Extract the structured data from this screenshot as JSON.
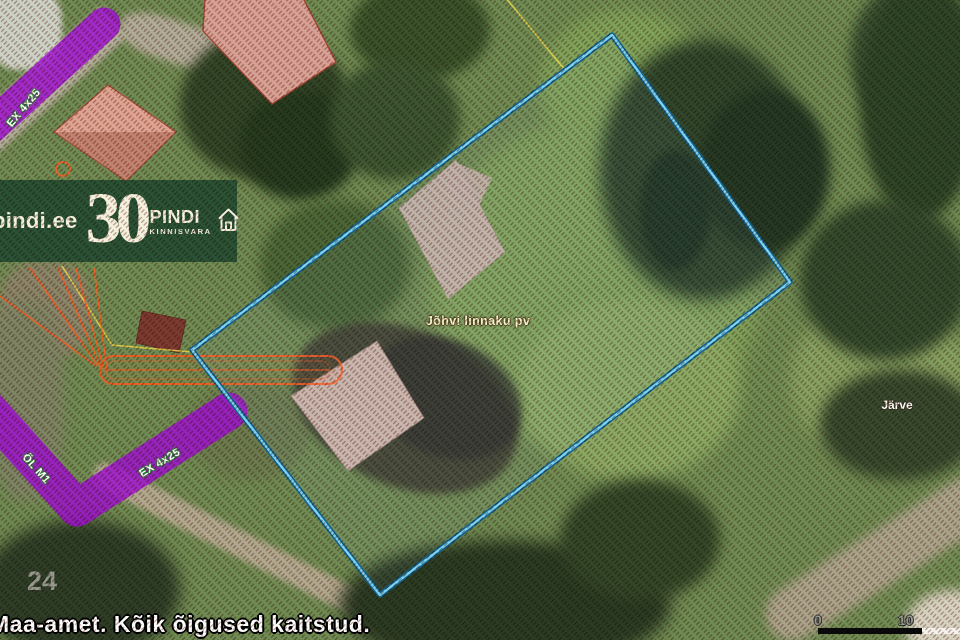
{
  "watermark_banner": {
    "site": "pindi.ee",
    "anniversary": "30",
    "brand": "PINDI",
    "brand_subtitle": "KINNISVARA",
    "background_color": "#2b5134",
    "text_color": "#f5f1e0"
  },
  "map_labels": {
    "property_name": "Jõhvi linnaku pv",
    "place_name": "Järve",
    "grid_number": "24"
  },
  "utility_labels": {
    "top_left_line": "EX 4x25",
    "left_line_vertical": "ÕL M1",
    "left_line_diagonal": "EX 4x25"
  },
  "scale_bar": {
    "start_label": "0",
    "end_label": "10"
  },
  "footer": {
    "copyright": "Maa-amet. Kõik õigused kaitstud."
  },
  "colors": {
    "parcel_boundary_outer": "#12608f",
    "parcel_boundary_inner": "#7ed3f2",
    "utility_purple": "#9a10cc",
    "utility_orange": "#ff5a1e",
    "cadastral_yellow": "#e8d44a",
    "hatch_watermark": "#7a341c",
    "banner_green": "#2b5134"
  }
}
